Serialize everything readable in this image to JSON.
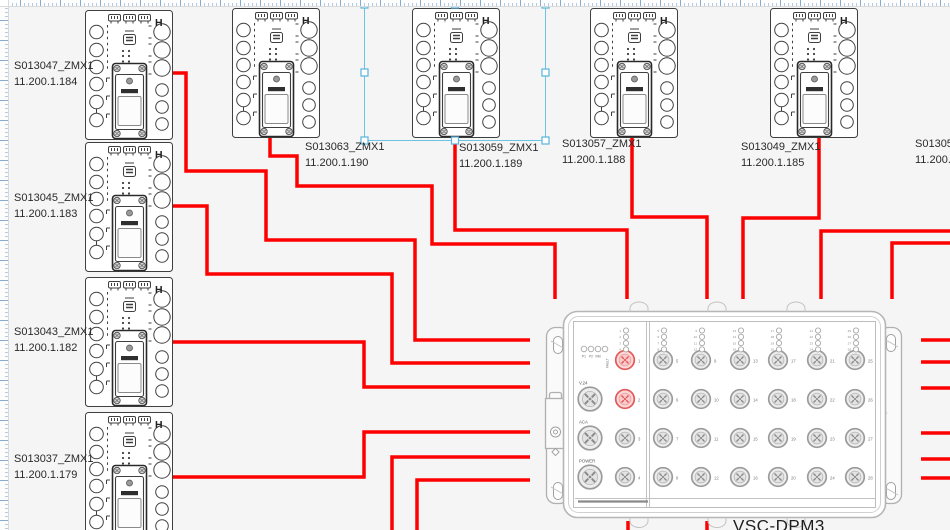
{
  "diagram": {
    "background": "#f5f5f5",
    "cable_color": "#fd0000",
    "selection_color": "#6cc3e4"
  },
  "devices": [
    {
      "name": "S013047_ZMX1",
      "ip": "11.200.1.184",
      "selected": false
    },
    {
      "name": "S013045_ZMX1",
      "ip": "11.200.1.183",
      "selected": false
    },
    {
      "name": "S013043_ZMX1",
      "ip": "11.200.1.182",
      "selected": false
    },
    {
      "name": "S013037_ZMX1",
      "ip": "11.200.1.179",
      "selected": false
    },
    {
      "name": "S013063_ZMX1",
      "ip": "11.200.1.190",
      "selected": false
    },
    {
      "name": "S013059_ZMX1",
      "ip": "11.200.1.189",
      "selected": true
    },
    {
      "name": "S013057_ZMX1",
      "ip": "11.200.1.188",
      "selected": false
    },
    {
      "name": "S013049_ZMX1",
      "ip": "11.200.1.185",
      "selected": false
    },
    {
      "name": "S013053",
      "ip": "11.200.1",
      "selected": false
    }
  ],
  "dpm": {
    "title": "VSC-DPM3",
    "logo": "H",
    "status_leds": [
      "P1",
      "P2",
      "RM",
      "FAULT"
    ],
    "aux_ports": [
      "V.24",
      "ACA",
      "POWER"
    ],
    "port_count": 28,
    "highlighted_ports": [
      1,
      2
    ]
  }
}
